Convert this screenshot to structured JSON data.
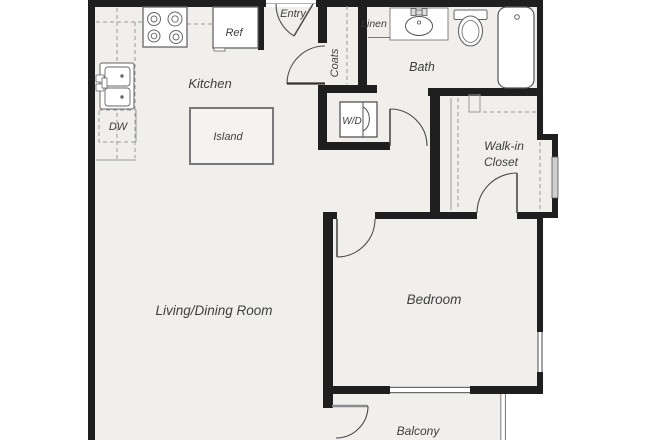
{
  "rooms": {
    "entry": "Entry",
    "kitchen": "Kitchen",
    "coats": "Coats",
    "linen": "Linen",
    "bath": "Bath",
    "walk_in_closet_line1": "Walk-in",
    "walk_in_closet_line2": "Closet",
    "bedroom": "Bedroom",
    "living_dining": "Living/Dining Room",
    "balcony": "Balcony"
  },
  "fixtures": {
    "refrigerator": "Ref",
    "dishwasher": "DW",
    "island": "Island",
    "washer_dryer": "W/D"
  },
  "colors": {
    "wall": "#1f1f1f",
    "floor": "#f0efec",
    "fixture_stroke": "#666666",
    "dashed_line": "#999999",
    "label": "#3f3f3f",
    "background": "#ffffff"
  }
}
